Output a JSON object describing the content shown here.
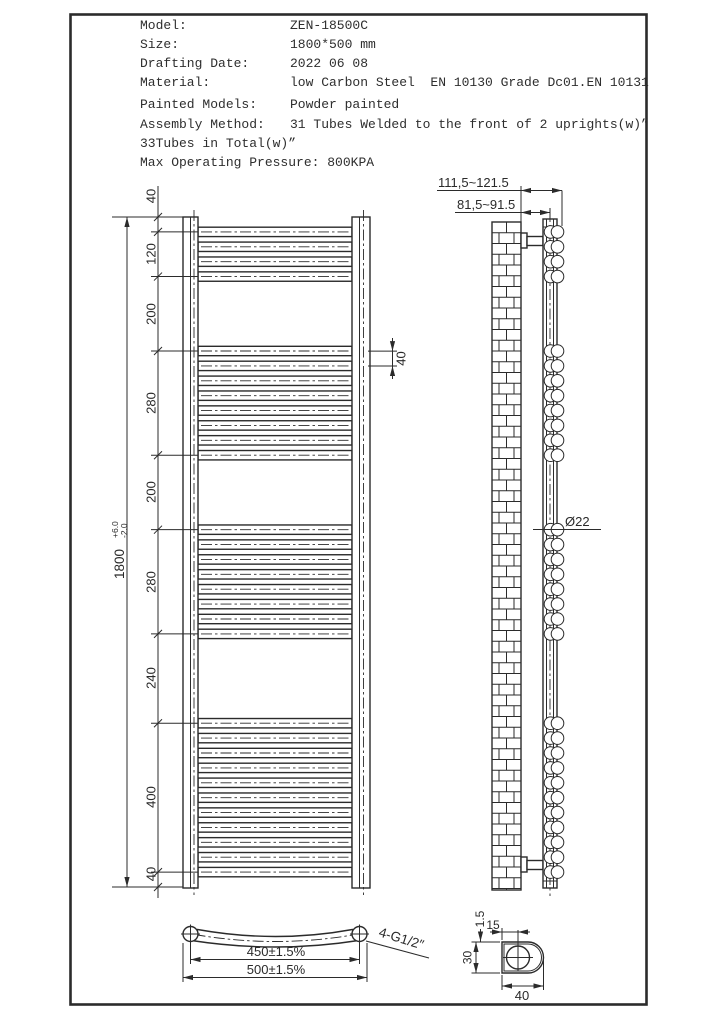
{
  "title_block": {
    "rows": [
      {
        "label": "Model:",
        "value": "ZEN-18500C"
      },
      {
        "label": "Size:",
        "value": "1800*500 mm"
      },
      {
        "label": "Drafting Date:",
        "value": "2022 06 08"
      },
      {
        "label": "Material:",
        "value": "low Carbon Steel  EN 10130 Grade Dc01.EN 10131"
      },
      {
        "label": "Painted Models:",
        "value": "Powder painted"
      },
      {
        "label": "Assembly Method:",
        "value": "31 Tubes Welded to the front of 2 uprights(w)”"
      }
    ],
    "note": "33Tubes in Total(w)”",
    "pressure": {
      "label": "Max Operating Pressure:",
      "value": "800KPA"
    }
  },
  "diagram": {
    "line_color": "#2b2b2b",
    "front_view": {
      "overall": {
        "value": "1800",
        "tol_plus": "+6.0",
        "tol_minus": "-2.0"
      },
      "chain_labels": [
        "40",
        "120",
        "200",
        "280",
        "200",
        "280",
        "240",
        "400",
        "40"
      ],
      "chain_dims_mm": [
        40,
        120,
        200,
        280,
        200,
        280,
        240,
        400,
        40
      ],
      "tube_pitch_label": "40",
      "tube_pitch_mm": 40,
      "tube_counts": [
        4,
        8,
        8,
        11
      ],
      "group_segments": [
        1,
        3,
        5,
        7
      ]
    },
    "side_view": {
      "wall_offset_dim": "111,5~121.5",
      "bracket_dim": "81,5~91.5",
      "tube_diameter": "Ø22"
    },
    "plan_view": {
      "center_distance": "450±1.5%",
      "overall_width": "500±1.5%",
      "thread_label": "4-G1/2″"
    },
    "detail_view": {
      "thickness": "1.5",
      "circle_offset": "15",
      "width": "30",
      "depth": "40"
    }
  }
}
